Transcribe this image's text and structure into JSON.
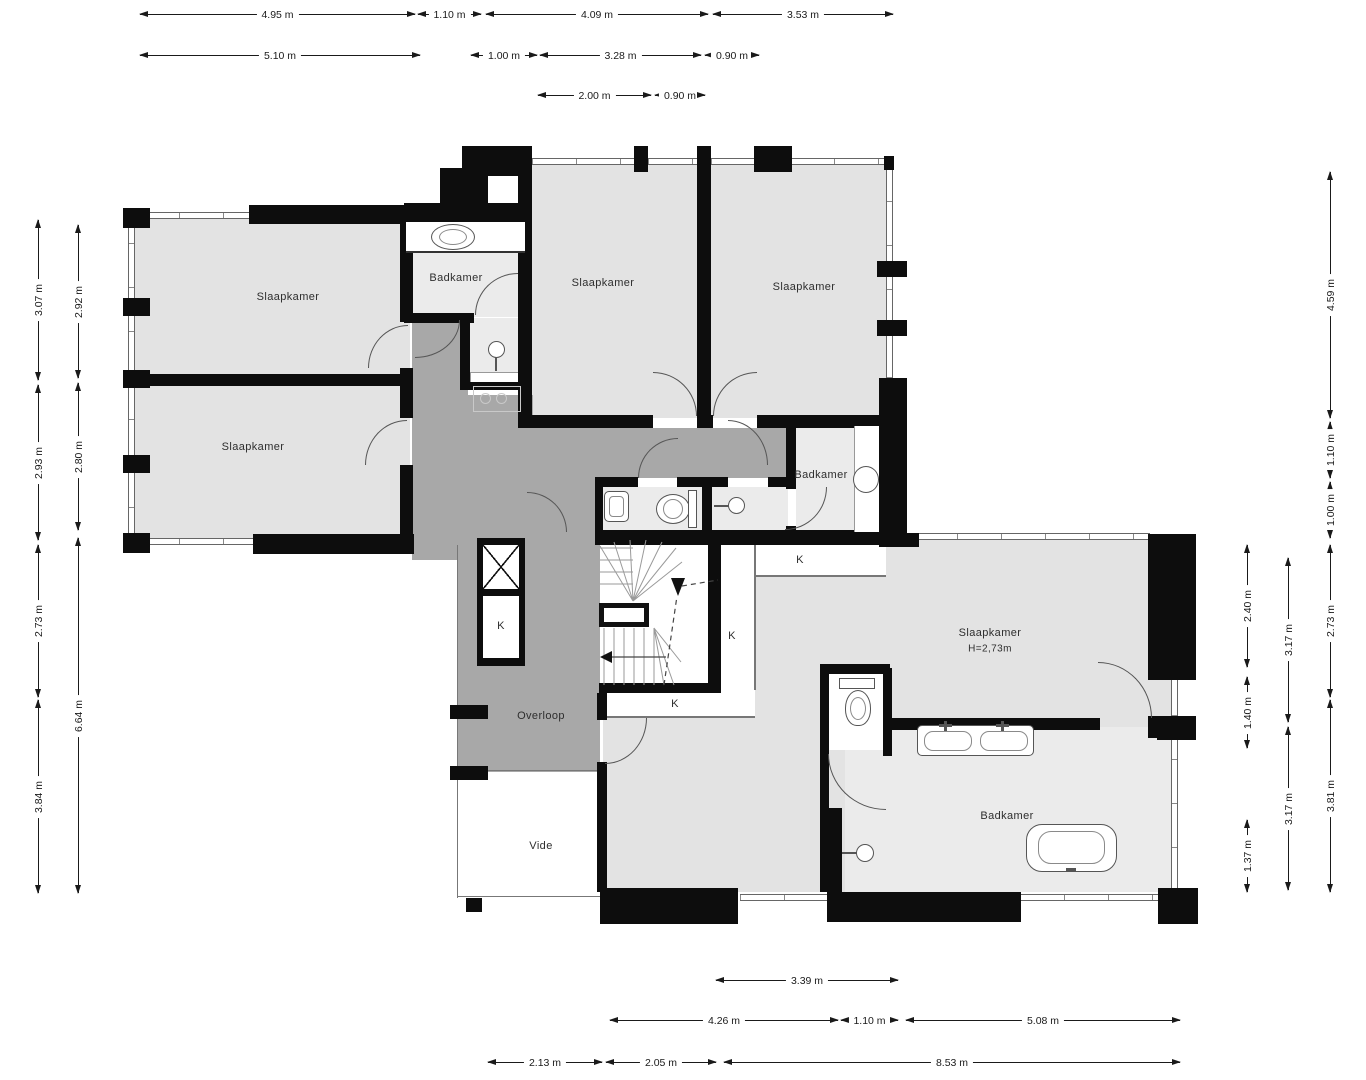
{
  "labels": {
    "slaapkamer_tl": "Slaapkamer",
    "slaapkamer_l": "Slaapkamer",
    "badkamer_tm": "Badkamer",
    "slaapkamer_tm": "Slaapkamer",
    "slaapkamer_tr": "Slaapkamer",
    "badkamer_mr": "Badkamer",
    "slaapkamer_main": "Slaapkamer",
    "slaapkamer_main_height": "H=2,73m",
    "badkamer_main": "Badkamer",
    "overloop": "Overloop",
    "vide": "Vide",
    "k_closet_1": "K",
    "k_closet_2": "K",
    "k_closet_3": "K",
    "k_closet_4": "K"
  },
  "dims": {
    "top1": [
      "4.95 m",
      "1.10 m",
      "4.09 m",
      "3.53 m"
    ],
    "top2": [
      "5.10 m",
      "1.00 m",
      "3.28 m",
      "0.90 m"
    ],
    "top3": [
      "2.00 m",
      "0.90 m"
    ],
    "left1": [
      "3.07 m",
      "2.93 m",
      "2.73 m",
      "3.84 m"
    ],
    "left2": [
      "2.92 m",
      "2.80 m",
      "6.64 m"
    ],
    "right1": [
      "2.40 m",
      "1.40 m",
      "1.37 m"
    ],
    "right2": [
      "3.17 m",
      "3.17 m"
    ],
    "right3": [
      "4.59 m",
      "1.10 m",
      "1.00 m",
      "2.73 m",
      "3.81 m"
    ],
    "bottom1": [
      "3.39 m"
    ],
    "bottom2": [
      "4.26 m",
      "1.10 m",
      "5.08 m"
    ],
    "bottom3": [
      "2.13 m",
      "2.05 m",
      "8.53 m"
    ]
  },
  "colors": {
    "wall": "#0d0d0d",
    "room_fill": "#e3e3e3",
    "bathroom_fill": "#ebebeb",
    "hall_fill": "#a8a8a8",
    "background": "#ffffff",
    "dimension_line": "#1a1a1a"
  }
}
